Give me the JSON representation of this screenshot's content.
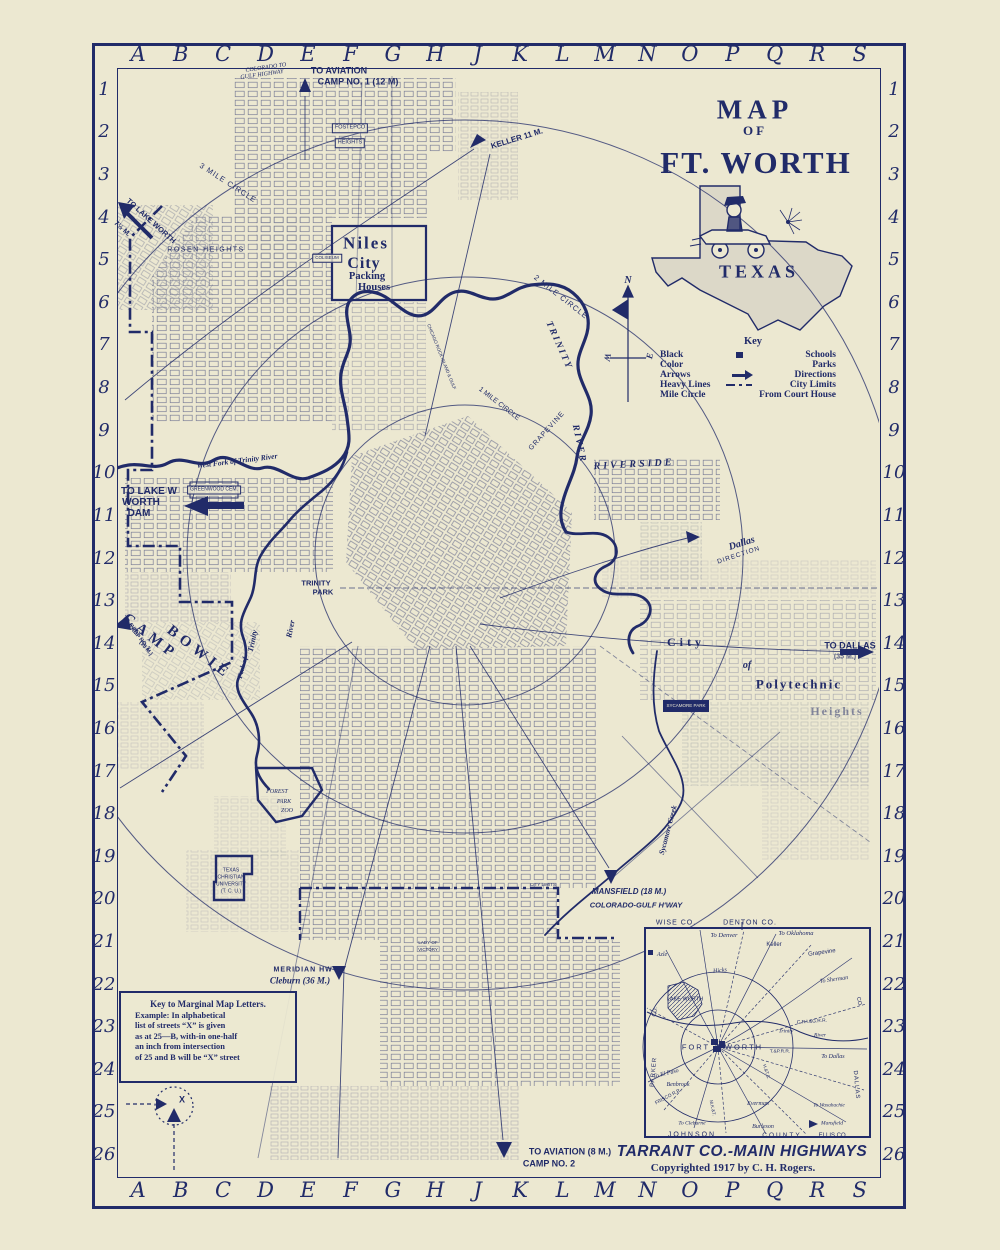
{
  "palette": {
    "bg": "#ece8d1",
    "ink": "#212b69"
  },
  "margins": {
    "letters": [
      "A",
      "B",
      "C",
      "D",
      "E",
      "F",
      "G",
      "H",
      "J",
      "K",
      "L",
      "M",
      "N",
      "O",
      "P",
      "Q",
      "R",
      "S"
    ],
    "numbers": [
      "1",
      "2",
      "3",
      "4",
      "5",
      "6",
      "7",
      "8",
      "9",
      "10",
      "11",
      "12",
      "13",
      "14",
      "15",
      "16",
      "17",
      "18",
      "19",
      "20",
      "21",
      "22",
      "23",
      "24",
      "25",
      "26"
    ]
  },
  "title": {
    "line1": "MAP",
    "line2": "OF",
    "line3": "FT. WORTH",
    "state": "TEXAS"
  },
  "key": {
    "heading": "Key",
    "rows": [
      {
        "left": "Black",
        "right": "Schools"
      },
      {
        "left": "Color",
        "right": "Parks"
      },
      {
        "left": "Arrows",
        "right": "Directions"
      },
      {
        "left": "Heavy Lines",
        "right": "City Limits"
      },
      {
        "left": "Mile Circle",
        "right": "From Court House"
      }
    ]
  },
  "marginal_key": {
    "title": "Key to Marginal Map Letters.",
    "lines": [
      "Example: In alphabetical",
      "list of streets “X” is given",
      "as at 25—B, with-in one-half",
      "an inch from intersection",
      "of 25 and B will be “X” street"
    ]
  },
  "inset": {
    "title": "TARRANT CO.-MAIN HIGHWAYS",
    "copyright": "Copyrighted 1917 by C. H. Rogers."
  },
  "labels": [
    {
      "t": "COLORADO TO",
      "x": 266,
      "y": 68,
      "fs": 6,
      "rot": -8,
      "cls": "ser it n"
    },
    {
      "t": "GULF HIGHWAY",
      "x": 262,
      "y": 75,
      "fs": 6,
      "rot": -8,
      "cls": "ser it n"
    },
    {
      "t": "TO AVIATION",
      "x": 339,
      "y": 71,
      "fs": 9
    },
    {
      "t": "CAMP NO. 1 (12 M)",
      "x": 358,
      "y": 82,
      "fs": 9
    },
    {
      "t": "KELLER 11 M.",
      "x": 517,
      "y": 139,
      "fs": 8,
      "rot": -17
    },
    {
      "t": "FOSTEPCO",
      "x": 350,
      "y": 128,
      "fs": 5.5,
      "cls": "box n"
    },
    {
      "t": "HEIGHTS",
      "x": 350,
      "y": 143,
      "fs": 5.5,
      "cls": "box n"
    },
    {
      "t": "TO LAKE WORTH",
      "x": 151,
      "y": 221,
      "fs": 7.5,
      "rot": 42
    },
    {
      "t": "7½ M.",
      "x": 122,
      "y": 229,
      "fs": 7,
      "rot": 42
    },
    {
      "t": "ROSEN HEIGHTS",
      "x": 206,
      "y": 250,
      "fs": 7,
      "ls": 1.5,
      "cls": "n"
    },
    {
      "t": "Niles",
      "x": 366,
      "y": 243,
      "fs": 17,
      "ls": 2,
      "cls": "ser"
    },
    {
      "t": "City",
      "x": 364,
      "y": 264,
      "fs": 16,
      "ls": 1,
      "cls": "ser"
    },
    {
      "t": "Packing",
      "x": 367,
      "y": 277,
      "fs": 10.5,
      "cls": "ser"
    },
    {
      "t": "Houses",
      "x": 374,
      "y": 288,
      "fs": 10.5,
      "cls": "ser"
    },
    {
      "t": "COLISEUM",
      "x": 327,
      "y": 258,
      "fs": 4.5,
      "cls": "box n"
    },
    {
      "t": "3 MILE CIRCLE",
      "x": 228,
      "y": 183,
      "fs": 7.5,
      "rot": 33,
      "ls": 1,
      "cls": "n"
    },
    {
      "t": "2 MILE CIRCLE",
      "x": 561,
      "y": 297,
      "fs": 7.5,
      "rot": 38,
      "ls": 1,
      "cls": "n"
    },
    {
      "t": "1 MILE CIRCLE",
      "x": 499,
      "y": 404,
      "fs": 7,
      "rot": 38,
      "cls": "n"
    },
    {
      "t": "TRINITY",
      "x": 558,
      "y": 346,
      "fs": 9.5,
      "rot": 66,
      "ls": 2,
      "cls": "ser it"
    },
    {
      "t": "RIVER",
      "x": 578,
      "y": 444,
      "fs": 9.5,
      "rot": 78,
      "ls": 2,
      "cls": "ser it"
    },
    {
      "t": "GRAPEVINE",
      "x": 547,
      "y": 431,
      "fs": 7,
      "rot": -48,
      "ls": 1,
      "cls": "n"
    },
    {
      "t": "RIVERSIDE",
      "x": 634,
      "y": 465,
      "fs": 10,
      "ls": 3,
      "rot": -3,
      "cls": "ser it"
    },
    {
      "t": "Dallas",
      "x": 742,
      "y": 544,
      "fs": 10,
      "rot": -18,
      "cls": "ser it"
    },
    {
      "t": "DIRECTION",
      "x": 739,
      "y": 556,
      "fs": 6.5,
      "rot": -18,
      "ls": 1,
      "cls": "n"
    },
    {
      "t": "West Fork of Trinity River",
      "x": 237,
      "y": 461,
      "fs": 7.5,
      "rot": -7,
      "cls": "ser it"
    },
    {
      "t": "TO LAKE W",
      "x": 149,
      "y": 492,
      "fs": 10
    },
    {
      "t": "WORTH",
      "x": 141,
      "y": 503,
      "fs": 10
    },
    {
      "t": "DAM",
      "x": 139,
      "y": 514,
      "fs": 10
    },
    {
      "t": "GREENWOOD CEM.",
      "x": 214,
      "y": 490,
      "fs": 5,
      "cls": "box n"
    },
    {
      "t": "TRINITY",
      "x": 316,
      "y": 583,
      "fs": 7.5
    },
    {
      "t": "PARK",
      "x": 323,
      "y": 592,
      "fs": 7.5
    },
    {
      "t": "CAMP",
      "x": 150,
      "y": 637,
      "fs": 15,
      "ls": 5,
      "rot": 38,
      "cls": "ser"
    },
    {
      "t": "BOWIE",
      "x": 199,
      "y": 653,
      "fs": 15,
      "ls": 5,
      "rot": 38,
      "cls": "ser"
    },
    {
      "t": "TO AVIAT.",
      "x": 131,
      "y": 627,
      "fs": 5.5,
      "rot": 50
    },
    {
      "t": "CAMP NO. 3",
      "x": 138,
      "y": 638,
      "fs": 5.5,
      "rot": 50
    },
    {
      "t": "(10 M.)",
      "x": 145,
      "y": 649,
      "fs": 5.5,
      "rot": 50
    },
    {
      "t": "Fork of",
      "x": 243,
      "y": 668,
      "fs": 7,
      "rot": -75,
      "cls": "ser it"
    },
    {
      "t": "Trinity",
      "x": 253,
      "y": 641,
      "fs": 8,
      "rot": -78,
      "cls": "ser it"
    },
    {
      "t": "River",
      "x": 291,
      "y": 629,
      "fs": 8,
      "rot": -78,
      "cls": "ser it"
    },
    {
      "t": "CHICAGO ROCK ISLAND & GULF",
      "x": 441,
      "y": 357,
      "fs": 4.5,
      "rot": 68,
      "cls": "n"
    },
    {
      "t": "City",
      "x": 686,
      "y": 642,
      "fs": 12,
      "ls": 4,
      "cls": "ser"
    },
    {
      "t": "of",
      "x": 747,
      "y": 666,
      "fs": 10,
      "cls": "ser it"
    },
    {
      "t": "Polytechnic",
      "x": 799,
      "y": 684,
      "fs": 13,
      "ls": 2,
      "cls": "ser"
    },
    {
      "t": "Heights",
      "x": 837,
      "y": 711,
      "fs": 12,
      "ls": 2,
      "op": 0.5,
      "cls": "ser"
    },
    {
      "t": "TO DALLAS",
      "x": 850,
      "y": 646,
      "fs": 9
    },
    {
      "t": "(35 M.)",
      "x": 845,
      "y": 657,
      "fs": 7,
      "op": 0.7
    },
    {
      "t": "SYCAMORE PARK",
      "x": 686,
      "y": 706,
      "fs": 4.5,
      "cls": "wb"
    },
    {
      "t": "Sycamore Creek",
      "x": 668,
      "y": 830,
      "fs": 7.5,
      "rot": -75,
      "cls": "ser it"
    },
    {
      "t": "FOREST",
      "x": 277,
      "y": 792,
      "fs": 6,
      "cls": "ser it n"
    },
    {
      "t": "PARK",
      "x": 284,
      "y": 802,
      "fs": 6,
      "cls": "ser it n"
    },
    {
      "t": "ZOO",
      "x": 287,
      "y": 811,
      "fs": 6,
      "cls": "ser it n"
    },
    {
      "t": "TEXAS",
      "x": 231,
      "y": 871,
      "fs": 5,
      "cls": "n"
    },
    {
      "t": "CHRISTIAN",
      "x": 231,
      "y": 878,
      "fs": 5,
      "cls": "n"
    },
    {
      "t": "UNIVERSITY",
      "x": 231,
      "y": 885,
      "fs": 5,
      "cls": "n"
    },
    {
      "t": "(T. C. U.)",
      "x": 231,
      "y": 892,
      "fs": 5,
      "cls": "n"
    },
    {
      "t": "CITY LIMITS",
      "x": 543,
      "y": 885,
      "fs": 4.5,
      "cls": "n"
    },
    {
      "t": "MANSFIELD (18 M.)",
      "x": 629,
      "y": 892,
      "fs": 8,
      "cls": "it"
    },
    {
      "t": "COLORADO-GULF H'WAY",
      "x": 636,
      "y": 905,
      "fs": 7.5,
      "cls": "it"
    },
    {
      "t": "MERIDIAN HWY",
      "x": 306,
      "y": 970,
      "fs": 7,
      "ls": 1
    },
    {
      "t": "Cleburn (36 M.)",
      "x": 300,
      "y": 981,
      "fs": 9,
      "cls": "ser it"
    },
    {
      "t": "LADY OF",
      "x": 428,
      "y": 943,
      "fs": 4.5,
      "cls": "n"
    },
    {
      "t": "VICTORY",
      "x": 428,
      "y": 950,
      "fs": 4.5,
      "cls": "n"
    },
    {
      "t": "TO AVIATION  (8 M.)",
      "x": 570,
      "y": 1152,
      "fs": 9
    },
    {
      "t": "CAMP NO. 2",
      "x": 549,
      "y": 1164,
      "fs": 9
    },
    {
      "t": "X",
      "x": 182,
      "y": 1100,
      "fs": 9
    },
    {
      "t": "N",
      "x": 628,
      "y": 281,
      "fs": 10,
      "cls": "ser it"
    },
    {
      "t": "W",
      "x": 607,
      "y": 357,
      "fs": 9,
      "rot": 100,
      "cls": "ser it"
    },
    {
      "t": "E",
      "x": 650,
      "y": 356,
      "fs": 9,
      "rot": -80,
      "cls": "ser it"
    },
    {
      "t": "WISE CO.",
      "x": 676,
      "y": 923,
      "fs": 7,
      "ls": 1,
      "cls": "n"
    },
    {
      "t": "DENTON CO.",
      "x": 750,
      "y": 923,
      "fs": 7,
      "ls": 1,
      "cls": "n"
    },
    {
      "t": "To Denver",
      "x": 724,
      "y": 936,
      "fs": 6.5,
      "cls": "ser it n"
    },
    {
      "t": "To Oklahoma",
      "x": 796,
      "y": 934,
      "fs": 6.5,
      "cls": "ser it n"
    },
    {
      "t": "Keller",
      "x": 774,
      "y": 945,
      "fs": 6,
      "cls": "n"
    },
    {
      "t": "Grapevine",
      "x": 822,
      "y": 953,
      "fs": 6,
      "rot": -8,
      "cls": "n"
    },
    {
      "t": "To Sherman",
      "x": 834,
      "y": 980,
      "fs": 6,
      "rot": -8,
      "cls": "ser it n"
    },
    {
      "t": "Azle",
      "x": 662,
      "y": 955,
      "fs": 6,
      "cls": "ser it n"
    },
    {
      "t": "Hicks",
      "x": 720,
      "y": 971,
      "fs": 6,
      "rot": -6,
      "cls": "ser it n"
    },
    {
      "t": "LAKE WORTH",
      "x": 685,
      "y": 1000,
      "fs": 5.5,
      "cls": "n"
    },
    {
      "t": "FORT",
      "x": 696,
      "y": 1047,
      "fs": 7.5,
      "ls": 2,
      "cls": "n"
    },
    {
      "t": "WORTH",
      "x": 744,
      "y": 1047,
      "fs": 7.5,
      "ls": 2,
      "cls": "n"
    },
    {
      "t": "C.R.I.&G.R.R.",
      "x": 812,
      "y": 1023,
      "fs": 4.8,
      "rot": -4,
      "cls": "n"
    },
    {
      "t": "Trinity",
      "x": 786,
      "y": 1032,
      "fs": 5.5,
      "cls": "ser it n"
    },
    {
      "t": "River",
      "x": 820,
      "y": 1036,
      "fs": 5.5,
      "cls": "ser it n"
    },
    {
      "t": "T.&P.R.R.",
      "x": 780,
      "y": 1053,
      "fs": 4.8,
      "cls": "n"
    },
    {
      "t": "To Dallas",
      "x": 833,
      "y": 1057,
      "fs": 6,
      "cls": "ser it n"
    },
    {
      "t": "H.&T.C.",
      "x": 766,
      "y": 1072,
      "fs": 4.5,
      "rot": 72,
      "cls": "n"
    },
    {
      "t": "To El Paso",
      "x": 666,
      "y": 1074,
      "fs": 6,
      "rot": -14,
      "cls": "ser it n"
    },
    {
      "t": "Benbrook",
      "x": 678,
      "y": 1085,
      "fs": 6,
      "cls": "ser it n"
    },
    {
      "t": "FRISCO R.R.",
      "x": 669,
      "y": 1098,
      "fs": 4.8,
      "rot": -28,
      "cls": "n"
    },
    {
      "t": "M.K.&T.",
      "x": 712,
      "y": 1108,
      "fs": 4.5,
      "rot": 78,
      "cls": "n"
    },
    {
      "t": "Everman",
      "x": 758,
      "y": 1104,
      "fs": 6,
      "cls": "ser it n"
    },
    {
      "t": "To Cleburne",
      "x": 692,
      "y": 1124,
      "fs": 5.5,
      "cls": "ser it n"
    },
    {
      "t": "Burleson",
      "x": 763,
      "y": 1127,
      "fs": 6,
      "cls": "ser it n"
    },
    {
      "t": "To Waxahachie",
      "x": 829,
      "y": 1106,
      "fs": 5.2,
      "cls": "ser it n"
    },
    {
      "t": "Mansfield",
      "x": 832,
      "y": 1124,
      "fs": 5.5,
      "cls": "ser it n"
    },
    {
      "t": "JOHNSON",
      "x": 692,
      "y": 1135,
      "fs": 7,
      "ls": 2,
      "cls": "n"
    },
    {
      "t": "COUNTY",
      "x": 782,
      "y": 1136,
      "fs": 6.5,
      "ls": 2,
      "cls": "n"
    },
    {
      "t": "ELLIS CO.",
      "x": 833,
      "y": 1136,
      "fs": 6,
      "cls": "n"
    },
    {
      "t": "PARKER",
      "x": 654,
      "y": 1072,
      "fs": 6,
      "ls": 1,
      "rot": -85,
      "cls": "n"
    },
    {
      "t": "CO.",
      "x": 656,
      "y": 1012,
      "fs": 5.5,
      "rot": -80,
      "cls": "n"
    },
    {
      "t": "DALLAS",
      "x": 856,
      "y": 1085,
      "fs": 6,
      "ls": 1,
      "rot": 85,
      "cls": "n"
    },
    {
      "t": "CO.",
      "x": 858,
      "y": 1002,
      "fs": 5.5,
      "rot": 80,
      "cls": "n"
    }
  ]
}
